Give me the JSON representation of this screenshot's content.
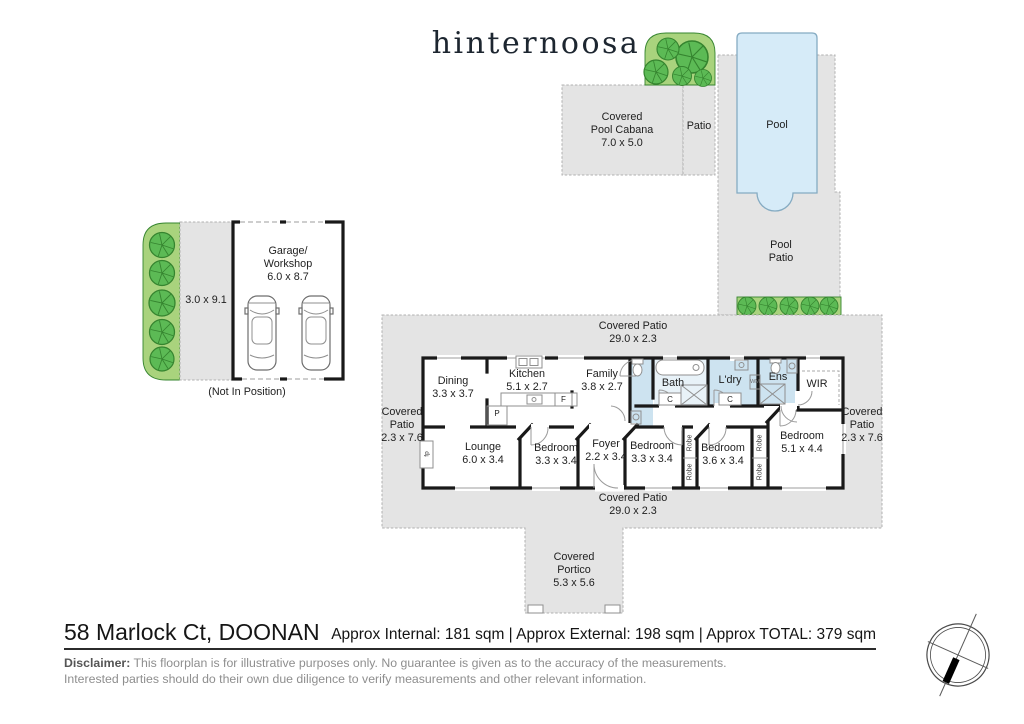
{
  "colors": {
    "paper": "#ffffff",
    "slab": "#e4e4e4",
    "slab_border": "#b0b0b0",
    "green": "#a9d37d",
    "tree": "#5cba55",
    "tree_dark": "#35842f",
    "pool": "#d6ebf8",
    "pool_border": "#85abc2",
    "wet": "#cde3f0",
    "wall": "#191919",
    "fixture": "#8f8f8f",
    "text": "#1e1e1e",
    "muted": "#8e8e8e",
    "logo_ink": "#1d2630",
    "rule": "#2b2b2b"
  },
  "logo": {
    "text": "hinternoosa"
  },
  "site": {
    "cabana": {
      "line1": "Covered",
      "line2": "Pool Cabana",
      "line3": "7.0 x 5.0"
    },
    "patio_strip": {
      "label": "Patio"
    },
    "pool": {
      "label": "Pool"
    },
    "pool_patio": {
      "line1": "Pool",
      "line2": "Patio"
    },
    "garage": {
      "line1": "Garage/",
      "line2": "Workshop",
      "line3": "6.0 x 8.7",
      "side_dim": "3.0 x 9.1",
      "note": "(Not In Position)"
    }
  },
  "plan": {
    "patio_top": {
      "line1": "Covered Patio",
      "line2": "29.0 x 2.3"
    },
    "patio_bottom": {
      "line1": "Covered Patio",
      "line2": "29.0 x 2.3"
    },
    "patio_left": {
      "line1": "Covered",
      "line2": "Patio",
      "line3": "2.3 x 7.6"
    },
    "patio_right": {
      "line1": "Covered",
      "line2": "Patio",
      "line3": "2.3 x 7.6"
    },
    "portico": {
      "line1": "Covered",
      "line2": "Portico",
      "line3": "5.3 x 5.6"
    },
    "rooms": {
      "dining": {
        "name": "Dining",
        "dims": "3.3 x 3.7"
      },
      "kitchen": {
        "name": "Kitchen",
        "dims": "5.1 x 2.7"
      },
      "family": {
        "name": "Family",
        "dims": "3.8 x 2.7"
      },
      "bath": {
        "name": "Bath"
      },
      "laundry": {
        "name": "L'dry"
      },
      "ensuite": {
        "name": "Ens"
      },
      "wir": {
        "name": "WIR"
      },
      "lounge": {
        "name": "Lounge",
        "dims": "6.0 x 3.4"
      },
      "bed1": {
        "name": "Bedroom",
        "dims": "3.3 x 3.4"
      },
      "foyer": {
        "name": "Foyer",
        "dims": "2.2 x 3.4"
      },
      "bed2": {
        "name": "Bedroom",
        "dims": "3.3 x 3.4"
      },
      "bed3": {
        "name": "Bedroom",
        "dims": "3.6 x 3.4"
      },
      "bed4": {
        "name": "Bedroom",
        "dims": "5.1 x 4.4"
      }
    },
    "fixtures": {
      "pantry": "P",
      "fridge": "F",
      "cupboard": "C",
      "washer": "WM",
      "robe": "Robe",
      "fireplace": "fp"
    }
  },
  "footer": {
    "address": "58 Marlock Ct, DOONAN",
    "areas": "Approx Internal: 181 sqm | Approx External: 198 sqm | Approx TOTAL: 379 sqm",
    "disclaimer_label": "Disclaimer:",
    "disclaimer_line1": "This floorplan is for illustrative purposes only. No guarantee is given as to the accuracy of the measurements.",
    "disclaimer_line2": "Interested parties should do their own due diligence to verify measurements and other relevant information."
  }
}
